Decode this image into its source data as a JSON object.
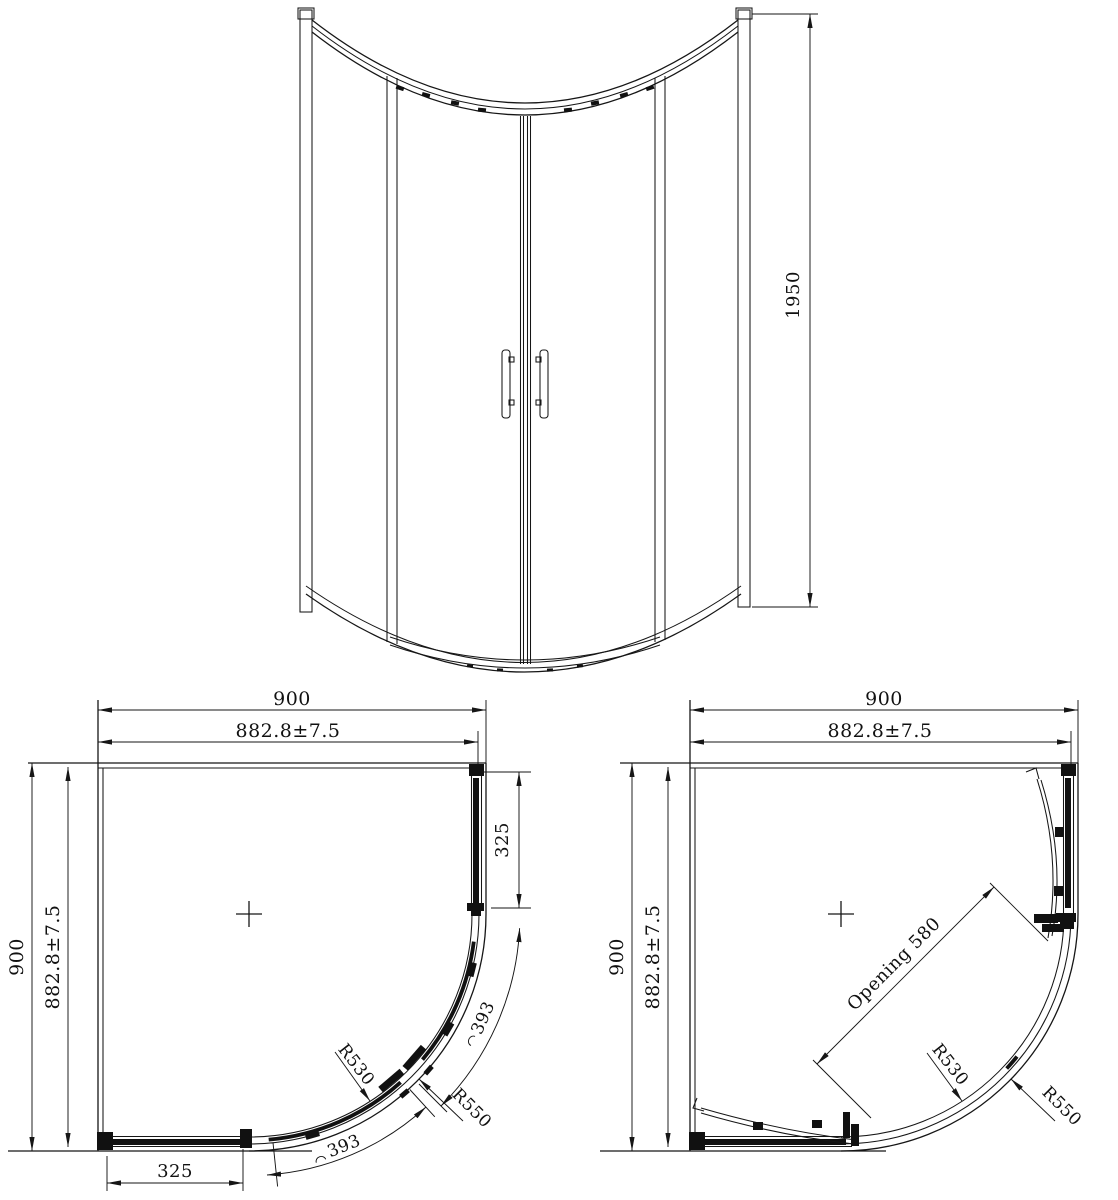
{
  "elevation": {
    "height": "1950"
  },
  "plan_closed": {
    "overall_width": "900",
    "adjustment_width": "882.8±7.5",
    "overall_depth": "900",
    "adjustment_depth": "882.8±7.5",
    "side_fixed_panel": "325",
    "front_fixed_panel": "325",
    "door_arc_upper": "393",
    "door_arc_lower": "393",
    "radius_inner": "R530",
    "radius_outer": "R550"
  },
  "plan_open": {
    "overall_width": "900",
    "adjustment_width": "882.8±7.5",
    "overall_depth": "900",
    "adjustment_depth": "882.8±7.5",
    "door_opening": "Opening 580",
    "radius_inner": "R530",
    "radius_outer": "R550"
  }
}
